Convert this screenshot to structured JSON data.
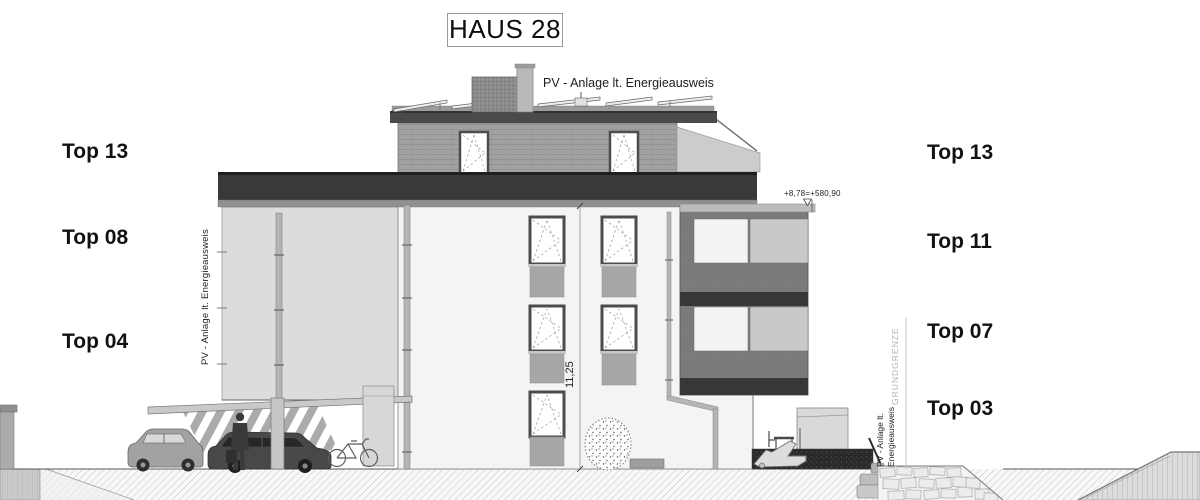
{
  "title": "HAUS 28",
  "roof_label": "PV - Anlage lt. Energieausweis",
  "left_labels": [
    "Top 13",
    "Top 08",
    "Top 04"
  ],
  "right_labels": [
    "Top 13",
    "Top 11",
    "Top 07",
    "Top 03"
  ],
  "side_texts": {
    "left_pv": "PV - Anlage lt. Energieausweis",
    "grundgrenze": "GRUNDGRENZE",
    "right_pv_line1": "PV - Anlage lt.",
    "right_pv_line2": "Energieausweis"
  },
  "measurements": {
    "height_dimension": "11,25",
    "elevation_marker": "+8,78=+580,90"
  },
  "colors": {
    "parapet_dark": "#39393b",
    "roof_slab": "#4a4a4c",
    "facade_white": "#f4f4f3",
    "wing_gray": "#dcdcdc",
    "balcony_gray": "#7c7c7e",
    "panel_gray": "#a7a7a7",
    "hedge_dark": "#29292b",
    "ground_line": "#555555"
  }
}
